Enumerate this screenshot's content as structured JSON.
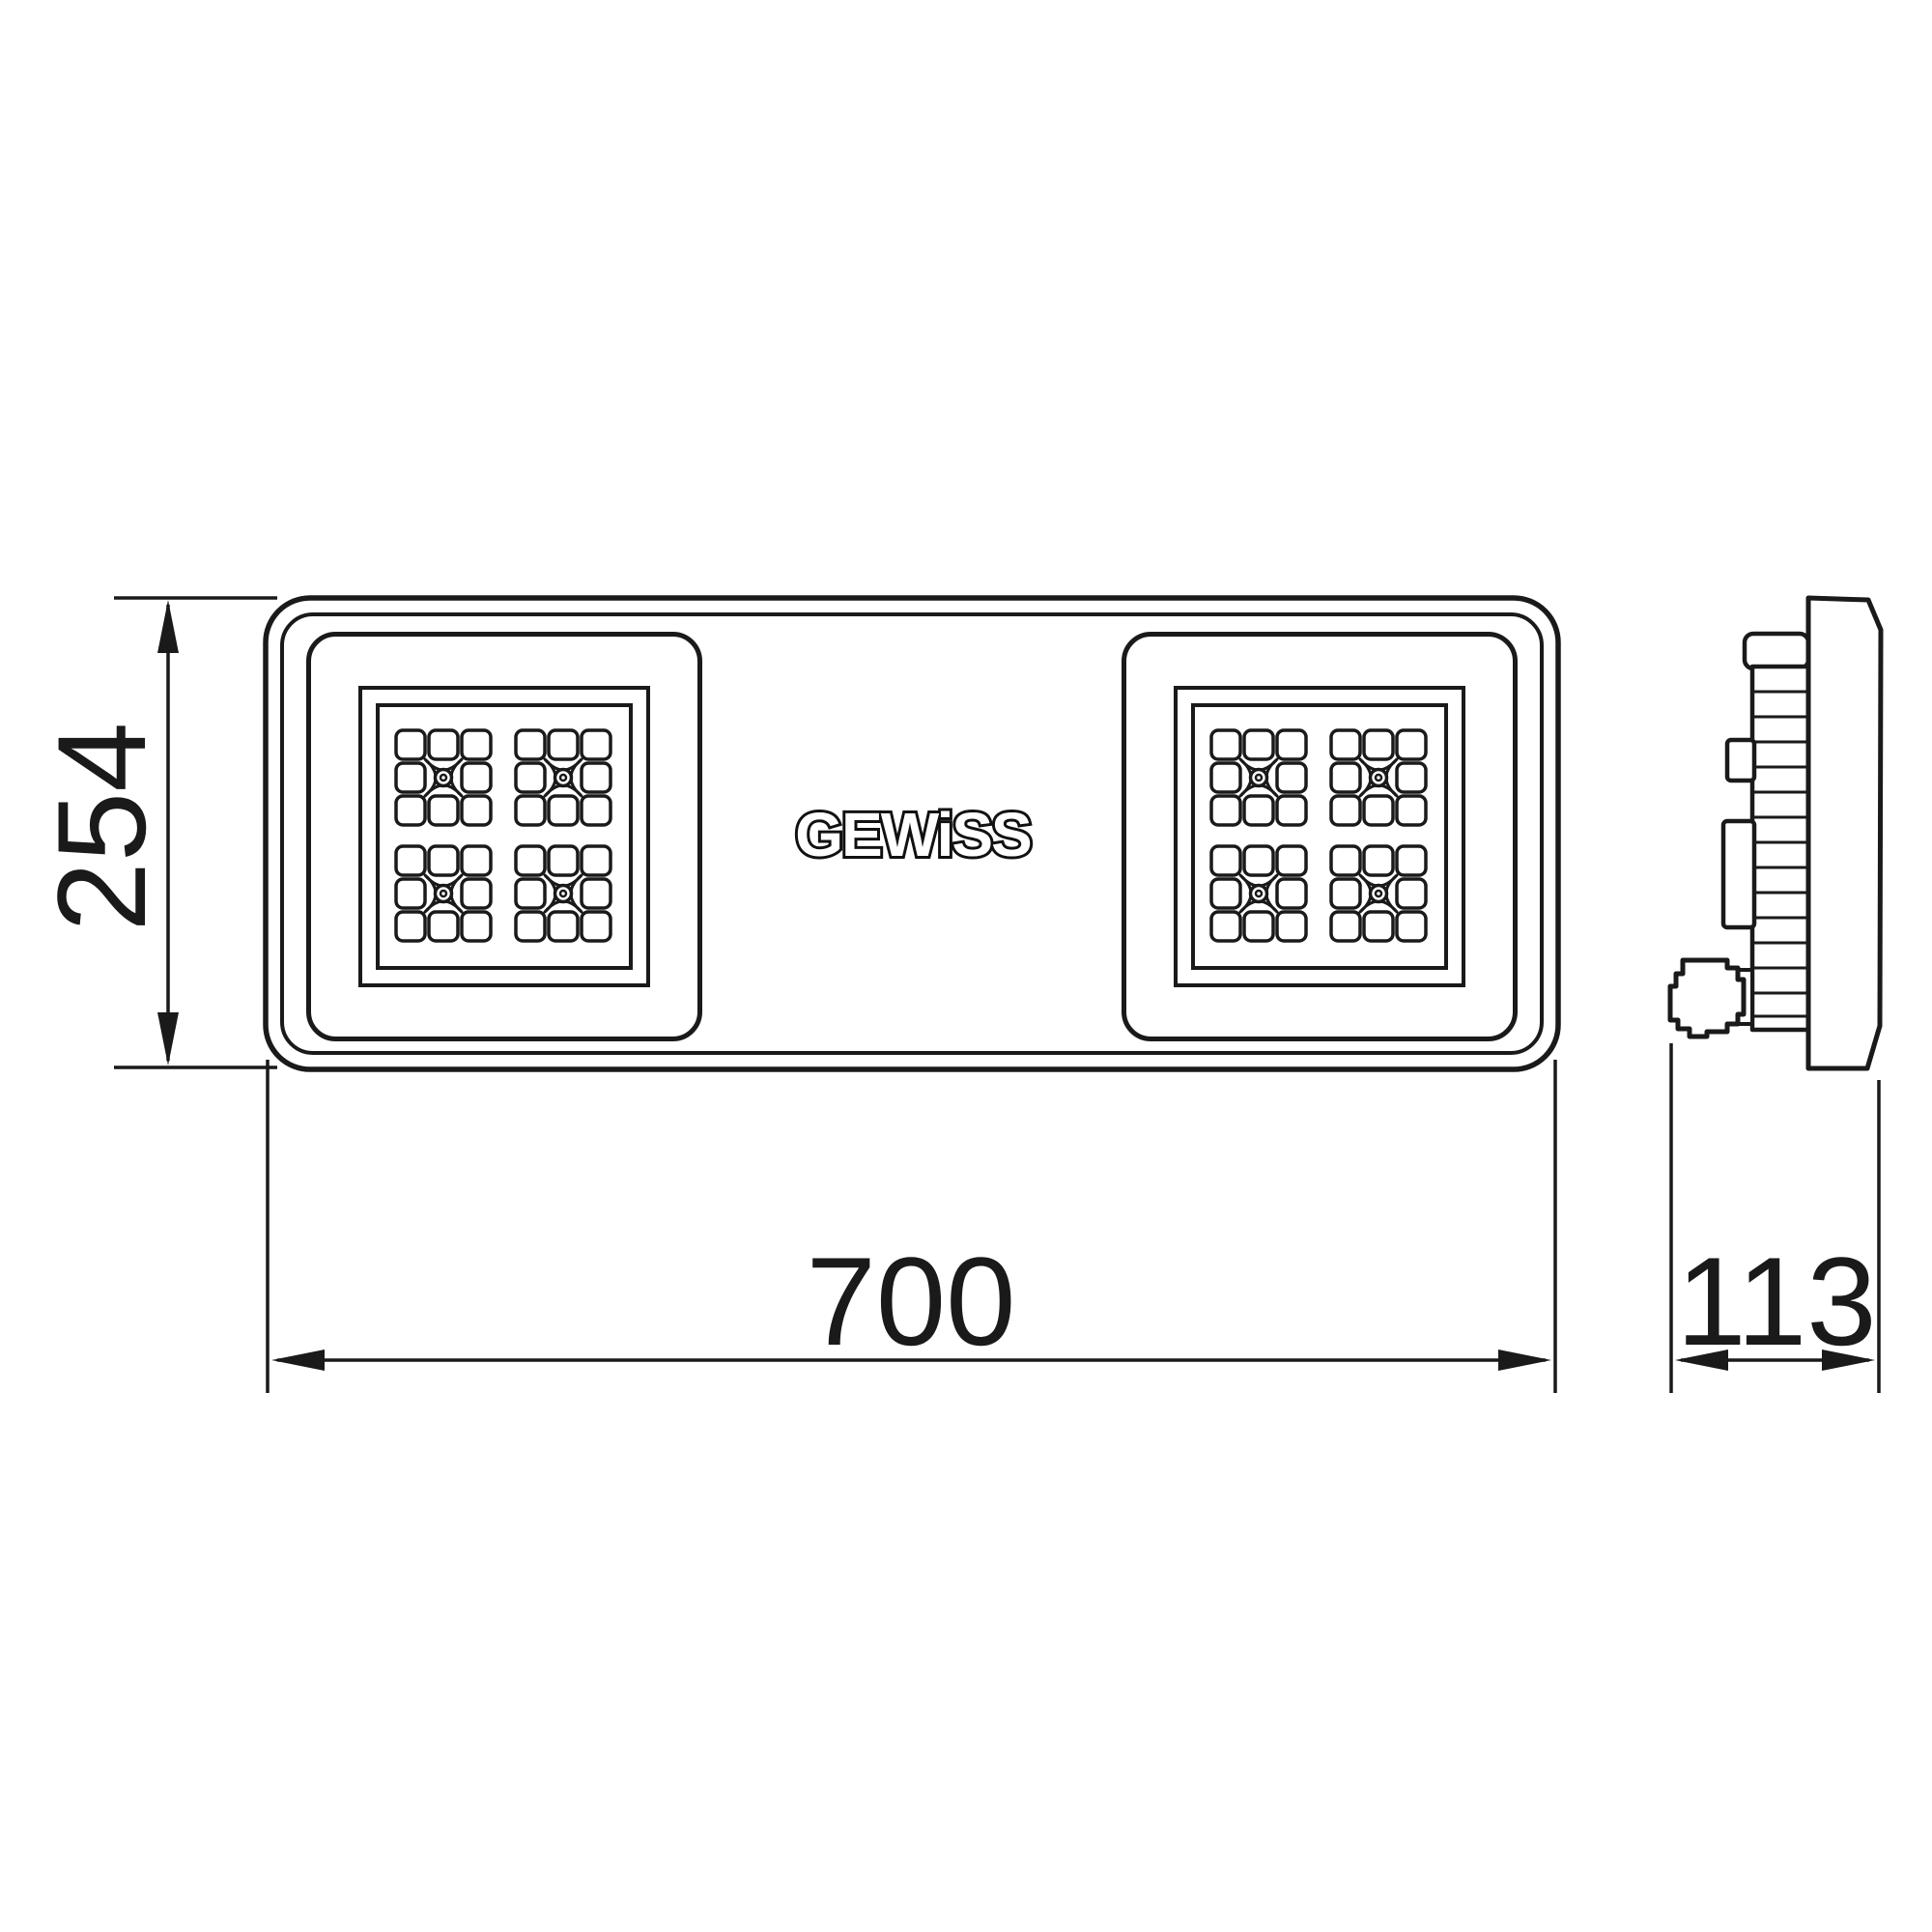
{
  "drawing": {
    "brand_logo": "GEWiSS",
    "dimensions": {
      "height": "254",
      "width": "700",
      "depth": "113"
    },
    "colors": {
      "line": "#1a1a1a",
      "background": "#ffffff"
    }
  }
}
